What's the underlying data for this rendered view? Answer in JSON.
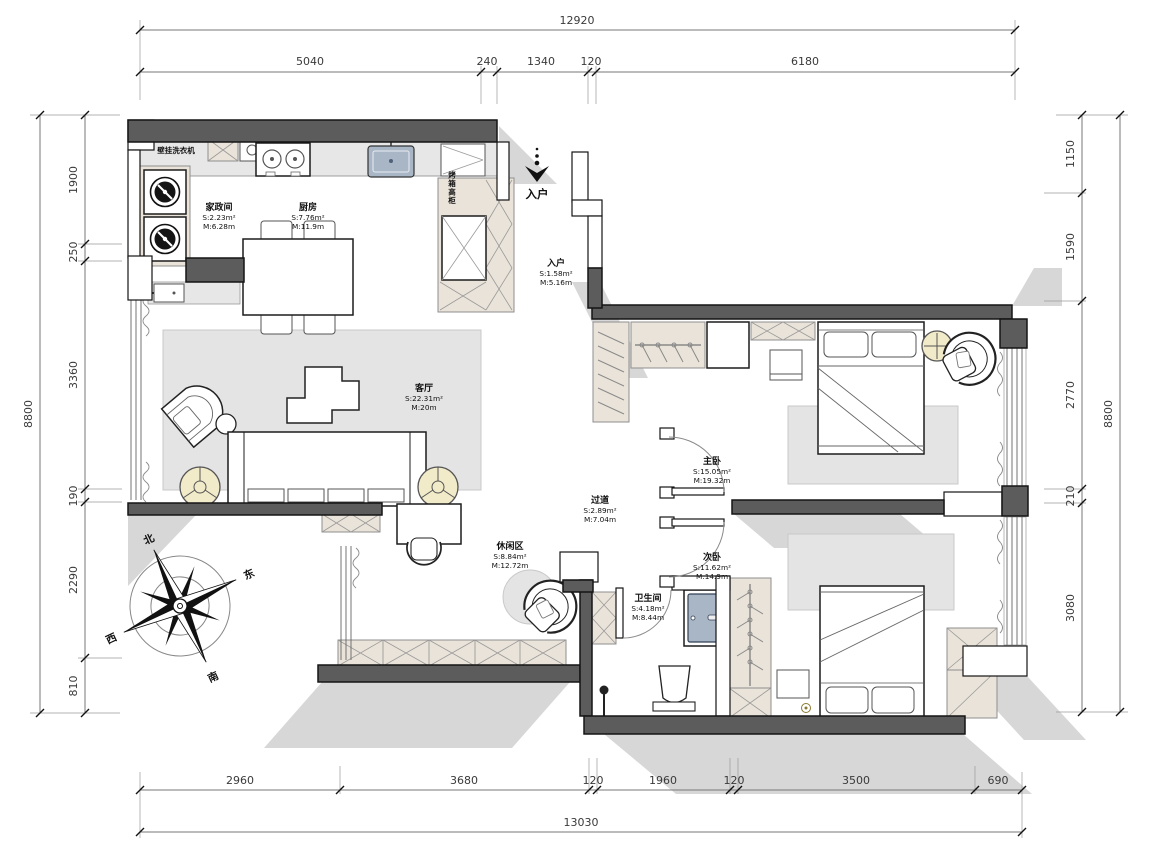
{
  "plan": {
    "rooms": {
      "laundry": {
        "name": "家政间",
        "s": "S:2.23m²",
        "m": "M:6.28m"
      },
      "kitchen": {
        "name": "厨房",
        "s": "S:7.76m²",
        "m": "M:11.9m"
      },
      "entry": {
        "name": "入户",
        "s": "S:1.58m²",
        "m": "M:5.16m"
      },
      "living": {
        "name": "客厅",
        "s": "S:22.31m²",
        "m": "M:20m"
      },
      "master": {
        "name": "主卧",
        "s": "S:15.05m²",
        "m": "M:19.32m"
      },
      "hallway": {
        "name": "过道",
        "s": "S:2.89m²",
        "m": "M:7.04m"
      },
      "second": {
        "name": "次卧",
        "s": "S:11.62m²",
        "m": "M:14.9m"
      },
      "leisure": {
        "name": "休闲区",
        "s": "S:8.84m²",
        "m": "M:12.72m"
      },
      "bathroom": {
        "name": "卫生间",
        "s": "S:4.18m²",
        "m": "M:8.44m"
      }
    },
    "annotations": {
      "washer": "壁挂洗衣机",
      "oven_cabinet": "烤箱高柜",
      "entry_arrow": "入户"
    },
    "compass": {
      "n": "北",
      "e": "东",
      "s": "南",
      "w": "西"
    }
  },
  "dimensions": {
    "top": {
      "total": "12920",
      "segments": [
        "5040",
        "240",
        "1340",
        "120",
        "6180"
      ]
    },
    "bottom": {
      "total": "13030",
      "segments": [
        "2960",
        "3680",
        "120",
        "1960",
        "120",
        "3500",
        "690"
      ]
    },
    "left": {
      "total": "8800",
      "segments": [
        "1900",
        "250",
        "3360",
        "190",
        "2290",
        "810"
      ]
    },
    "right": {
      "total": "8800",
      "segments": [
        "1150",
        "1590",
        "2770",
        "210",
        "3080"
      ]
    }
  },
  "colors": {
    "wall": "#5c5c5c",
    "shadow": "#d7d7d7",
    "rug": "#e4e4e4",
    "cabinet_beige": "#eae3d9",
    "sink_blue": "#a9b6c6",
    "table_beige": "#f2ebc9",
    "background": "#ffffff"
  }
}
